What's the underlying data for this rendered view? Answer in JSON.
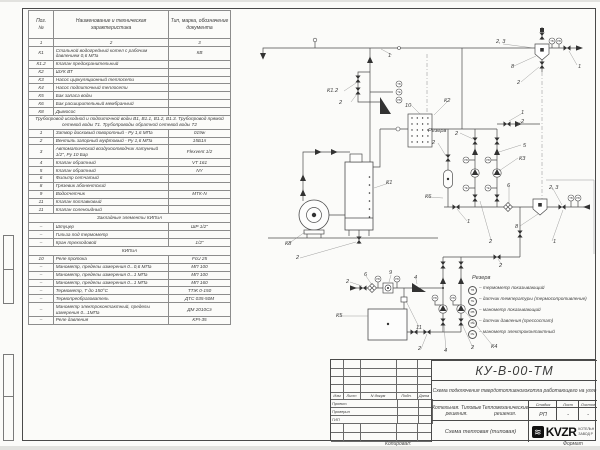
{
  "parts_table": {
    "headers": {
      "pos": "Поз.\n№",
      "name": "Наименование и техническая характеристика",
      "type": "Тип, марка, обозначение документа"
    },
    "rows": [
      {
        "kind": "cols",
        "c": [
          "1",
          "2",
          "3"
        ]
      },
      {
        "kind": "item",
        "pos": "К1",
        "name": "Стальной водогрейный котел с рабочим давлением 0,6 МПа",
        "type": "КВ"
      },
      {
        "kind": "item",
        "pos": "К1.2",
        "name": "Клапан предохранительный",
        "type": ""
      },
      {
        "kind": "item",
        "pos": "К2",
        "name": "ШУК ВТ",
        "type": ""
      },
      {
        "kind": "item",
        "pos": "К3",
        "name": "Насос циркуляционный теплосети",
        "type": ""
      },
      {
        "kind": "item",
        "pos": "К4",
        "name": "Насос подпиточный теплосети",
        "type": ""
      },
      {
        "kind": "item",
        "pos": "К5",
        "name": "Бак запаса воды",
        "type": ""
      },
      {
        "kind": "item",
        "pos": "К6",
        "name": "Бак расширительный мембранный",
        "type": ""
      },
      {
        "kind": "item",
        "pos": "К8",
        "name": "Дымосос",
        "type": ""
      },
      {
        "kind": "note",
        "text": "Трубопровод исходной и подпиточной воды В1, В1.1, В1.2, В1.3. Трубопровод прямой сетевой воды Т1. Трубопроводы обратной сетевой воды Т2"
      },
      {
        "kind": "item",
        "pos": "1",
        "name": "Затвор дисковый поворотный - Ру 1,6 МПа",
        "type": "019w"
      },
      {
        "kind": "item",
        "pos": "2",
        "name": "Вентиль запорный муфтовый - Ру 1,6 МПа",
        "type": "15Б1п"
      },
      {
        "kind": "item",
        "pos": "3",
        "name": "Автоматический воздухоотводчик латунный 1/2\", Ру 10 Бар",
        "type": "Flexvent 1/2"
      },
      {
        "kind": "item",
        "pos": "4",
        "name": "Клапан обратный",
        "type": "VT 161"
      },
      {
        "kind": "item",
        "pos": "5",
        "name": "Клапан обратный",
        "type": "NY"
      },
      {
        "kind": "item",
        "pos": "6",
        "name": "Фильтр сетчатый",
        "type": ""
      },
      {
        "kind": "item",
        "pos": "8",
        "name": "Грязевик абонентский",
        "type": ""
      },
      {
        "kind": "item",
        "pos": "9",
        "name": "Водосчетчик",
        "type": "МТК-N"
      },
      {
        "kind": "item",
        "pos": "11",
        "name": "Клапан поплавковый",
        "type": ""
      },
      {
        "kind": "item",
        "pos": "11",
        "name": "Клапан соленоидный",
        "type": ""
      },
      {
        "kind": "section",
        "text": "Закладные элементы КИПиА"
      },
      {
        "kind": "item",
        "pos": "–",
        "name": "Штуцер",
        "type": "ШР 1/2\""
      },
      {
        "kind": "item",
        "pos": "–",
        "name": "Гильза под термометр",
        "type": ""
      },
      {
        "kind": "item",
        "pos": "–",
        "name": "Кран трехходовой",
        "type": "1/2\""
      },
      {
        "kind": "section",
        "text": "КИПиА"
      },
      {
        "kind": "item",
        "pos": "10",
        "name": "Реле протока",
        "type": "FcU 25"
      },
      {
        "kind": "item",
        "pos": "–",
        "name": "Манометр, пределы измерения 0...0,6 МПа",
        "type": "МП 100"
      },
      {
        "kind": "item",
        "pos": "–",
        "name": "Манометр, пределы измерения 0...1 МПа",
        "type": "МП 100"
      },
      {
        "kind": "item",
        "pos": "–",
        "name": "Манометр, пределы измерения 0...1 МПа",
        "type": "МП 160"
      },
      {
        "kind": "item",
        "pos": "–",
        "name": "Термометр, Т до 150°С",
        "type": "ТТЖ 0-150"
      },
      {
        "kind": "item",
        "pos": "–",
        "name": "Термопреобразователь",
        "type": "ДТС 035-50М"
      },
      {
        "kind": "item",
        "pos": "–",
        "name": "Манометр электроконтактный, пределы измерения 0...1МПа",
        "type": "ДМ 2010Сг"
      },
      {
        "kind": "item",
        "pos": "–",
        "name": "Реле давления",
        "type": "KPI-35"
      }
    ]
  },
  "schematic": {
    "labels": [
      {
        "t": "1",
        "x": 388,
        "y": 55
      },
      {
        "t": "К1.2",
        "x": 327,
        "y": 90
      },
      {
        "t": "2",
        "x": 339,
        "y": 102
      },
      {
        "t": "2, 3",
        "x": 496,
        "y": 41
      },
      {
        "t": "8",
        "x": 511,
        "y": 66
      },
      {
        "t": "2",
        "x": 517,
        "y": 82
      },
      {
        "t": "1",
        "x": 578,
        "y": 66
      },
      {
        "t": "10",
        "x": 405,
        "y": 105
      },
      {
        "t": "К2",
        "x": 444,
        "y": 100
      },
      {
        "t": "Резерв",
        "x": 428,
        "y": 130
      },
      {
        "t": "2",
        "x": 432,
        "y": 142
      },
      {
        "t": "1",
        "x": 521,
        "y": 112
      },
      {
        "t": "2",
        "x": 521,
        "y": 121
      },
      {
        "t": "К1",
        "x": 386,
        "y": 182
      },
      {
        "t": "К8",
        "x": 285,
        "y": 243
      },
      {
        "t": "2",
        "x": 296,
        "y": 257
      },
      {
        "t": "2",
        "x": 455,
        "y": 133
      },
      {
        "t": "5",
        "x": 523,
        "y": 145
      },
      {
        "t": "К3",
        "x": 519,
        "y": 158
      },
      {
        "t": "6",
        "x": 507,
        "y": 185
      },
      {
        "t": "1",
        "x": 467,
        "y": 221
      },
      {
        "t": "2",
        "x": 489,
        "y": 241
      },
      {
        "t": "2, 3",
        "x": 549,
        "y": 187
      },
      {
        "t": "8",
        "x": 515,
        "y": 226
      },
      {
        "t": "1",
        "x": 553,
        "y": 241
      },
      {
        "t": "2",
        "x": 499,
        "y": 265
      },
      {
        "t": "2",
        "x": 346,
        "y": 281
      },
      {
        "t": "6",
        "x": 364,
        "y": 274
      },
      {
        "t": "9",
        "x": 389,
        "y": 272
      },
      {
        "t": "4",
        "x": 414,
        "y": 277
      },
      {
        "t": "К5",
        "x": 336,
        "y": 315
      },
      {
        "t": "11",
        "x": 416,
        "y": 327
      },
      {
        "t": "Резерв",
        "x": 472,
        "y": 277
      },
      {
        "t": "2",
        "x": 418,
        "y": 348
      },
      {
        "t": "4",
        "x": 444,
        "y": 350
      },
      {
        "t": "2",
        "x": 471,
        "y": 347
      },
      {
        "t": "К4",
        "x": 491,
        "y": 346
      },
      {
        "t": "К6",
        "x": 425,
        "y": 196
      }
    ],
    "instruments": [
      {
        "tag": "ТВ",
        "x": 552,
        "y": 39
      },
      {
        "tag": "РВ",
        "x": 559,
        "y": 39
      },
      {
        "tag": "ТВ",
        "x": 399,
        "y": 82
      },
      {
        "tag": "ТЕ",
        "x": 399,
        "y": 90
      },
      {
        "tag": "РВ",
        "x": 399,
        "y": 98
      },
      {
        "tag": "РВ",
        "x": 466,
        "y": 158
      },
      {
        "tag": "РВ",
        "x": 488,
        "y": 158
      },
      {
        "tag": "ТЕ",
        "x": 466,
        "y": 186
      },
      {
        "tag": "ТЕ",
        "x": 488,
        "y": 186
      },
      {
        "tag": "ТВ",
        "x": 571,
        "y": 196
      },
      {
        "tag": "РВ",
        "x": 578,
        "y": 196
      },
      {
        "tag": "РВ",
        "x": 378,
        "y": 277
      },
      {
        "tag": "РВ",
        "x": 397,
        "y": 277
      },
      {
        "tag": "РВ",
        "x": 435,
        "y": 296
      },
      {
        "tag": "РВ",
        "x": 453,
        "y": 296
      }
    ],
    "legend": {
      "items": [
        {
          "tag": "ТВ",
          "text": "– термометр показывающий"
        },
        {
          "tag": "ТЕ",
          "text": "– датчик температуры (термосопротивление)"
        },
        {
          "tag": "РВ",
          "text": "– манометр показывающий"
        },
        {
          "tag": "РЕ",
          "text": "– датчик давления (прессостат)"
        },
        {
          "tag": "РЕ",
          "text": "– манометр электроконтактный"
        }
      ]
    }
  },
  "title_block": {
    "doc_number": "КУ-В-00-ТМ",
    "subtitle": "Схема подключения твердотопливного\nкотла работающего на угле",
    "object": "Котельная. Типовые решения.\nТепломеханические решения.",
    "sheet_name": "Схема тепловая (типовая)",
    "stage_header": "Стадия",
    "sheet_header": "Лист",
    "sheets_header": "Листов",
    "stage": "РП",
    "sheet": "-",
    "sheets": "-",
    "sig_headers": [
      "Изм",
      "Лист",
      "N докум",
      "Подп.",
      "Дата"
    ],
    "sig_rows": [
      "Проект.",
      "Проверил",
      "ГИП"
    ],
    "logo_text": "KVZR",
    "logo_mark": "≋",
    "company": "КОТЕЛЬН\nЗАВОД Р"
  },
  "footer": {
    "copied": "Копировал:",
    "format": "Формат"
  }
}
